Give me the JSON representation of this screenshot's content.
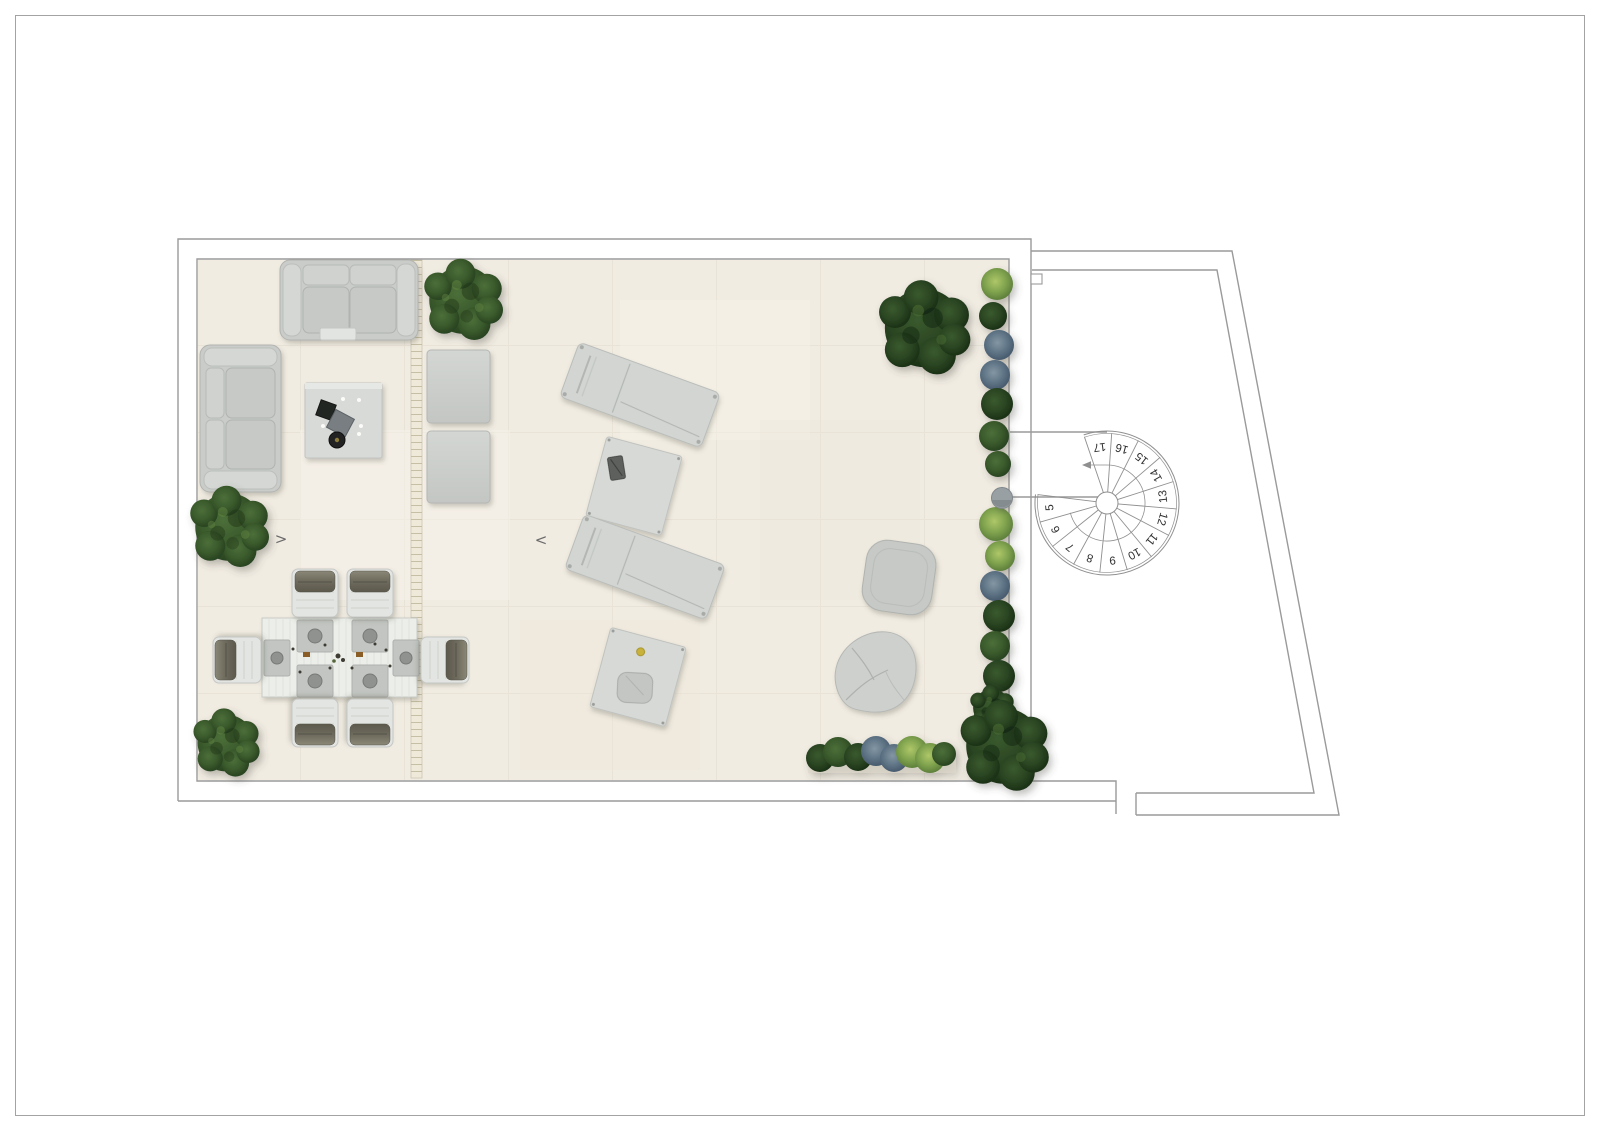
{
  "document": {
    "type": "terrace-floor-plan",
    "page_background": "#ffffff",
    "frame_color": "#a3a3a3"
  },
  "colors": {
    "floor": "#f1ece2",
    "tile_joint": "#e5ded1",
    "wall_line": "#9a9a9a",
    "furniture_gray": "#cbcecb",
    "cushion_dark": "#6f6c5e",
    "foliage_green": "#3a5a2c",
    "foliage_dark": "#243b1e",
    "planter_light_green": "#8fae57",
    "planter_blue_gray": "#5f7586",
    "stair_number_color": "#2e2e2e",
    "drain_channel": "#efe9da"
  },
  "stairs": {
    "steps": [
      "5",
      "6",
      "7",
      "8",
      "9",
      "10",
      "11",
      "12",
      "13",
      "14",
      "15",
      "16",
      "17"
    ],
    "direction": "up-counterclockwise"
  },
  "markers": {
    "slope_arrow_right": ">",
    "slope_arrow_left": "<"
  },
  "furniture_items": [
    "three-seat-sofa",
    "two-seat-sofa",
    "coffee-table",
    "ottoman",
    "ottoman",
    "sun-lounger",
    "sun-lounger",
    "side-table",
    "side-table",
    "dining-table",
    "dining-chair-x6",
    "pouf",
    "bean-bag",
    "spiral-staircase",
    "planter-strip-right",
    "planter-strip-bottom",
    "shrub-x5"
  ]
}
